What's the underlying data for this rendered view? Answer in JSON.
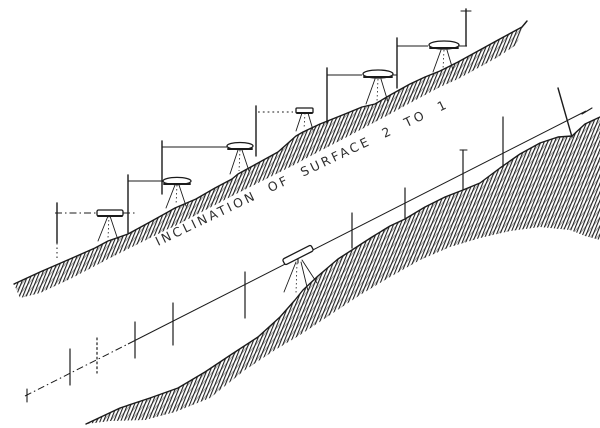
{
  "figure": {
    "kind": "engraved surveying illustration",
    "slope_label": "INCLINATION OF SURFACE 2 TO 1",
    "upper_slope": {
      "instrument_count": 6,
      "staff_count": 7,
      "sight_line_style": "dash-dot and solid horizontals"
    },
    "lower_slope": {
      "instrument_count": 1,
      "picket_count": 9,
      "sight_line_style": "inclined line parallel to surface"
    }
  },
  "colors": {
    "ink": "#1b1b1b",
    "paper": "#ffffff"
  }
}
